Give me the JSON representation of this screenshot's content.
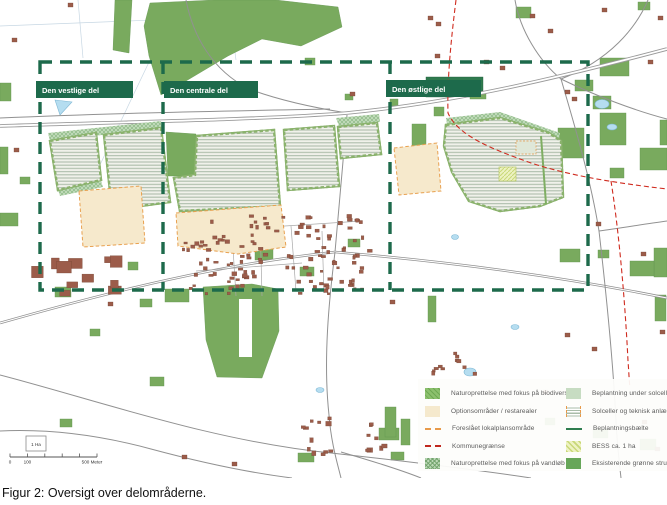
{
  "figure": {
    "caption": "Figur 2: Oversigt over delområderne."
  },
  "map": {
    "area_labels": [
      {
        "id": "west",
        "label": "Den vestlige del"
      },
      {
        "id": "central",
        "label": "Den centrale del"
      },
      {
        "id": "east",
        "label": "Den østlige del"
      }
    ],
    "scale_bar": {
      "area_unit": "1 Ha",
      "zero": "0",
      "hundred": "100",
      "end": "500 Meter"
    },
    "legend": {
      "left": [
        {
          "label": "Naturoprettelse med fokus på biodiversitet",
          "swatch": "green-diagonal-hatch",
          "color": "#8cc06d"
        },
        {
          "label": "Optionsområder / restarealer",
          "swatch": "solid",
          "color": "#f5e9cd"
        },
        {
          "label": "Foreslået lokalplansområde",
          "swatch": "dashed-line",
          "color": "#e89a4a"
        },
        {
          "label": "Kommunegrænse",
          "swatch": "dashed-line",
          "color": "#c0281e"
        },
        {
          "label": "Naturoprettelse med fokus på vandløb",
          "swatch": "green-crosshatch",
          "color": "#bcd9b7"
        }
      ],
      "right": [
        {
          "label": "Beplantning under solceller",
          "swatch": "solid",
          "color": "#c7dcc2"
        },
        {
          "label": "Solceller og teknisk anlæg",
          "swatch": "horizontal-stripes",
          "color": "#a9bca9"
        },
        {
          "label": "Beplantningsbælte",
          "swatch": "solid-line",
          "color": "#2e7d4f"
        },
        {
          "label": "BESS ca. 1 ha",
          "swatch": "yellow-diagonal-hatch",
          "color": "#eef2c2"
        },
        {
          "label": "Eksisterende grønne strukturer",
          "swatch": "solid",
          "color": "#67a659"
        }
      ]
    },
    "palette": {
      "boundary_green": "#1d6a4b",
      "kommunegraense_red": "#cf2b1f",
      "lokalplan_orange": "#e89a4a",
      "building_brown": "#9c5c4a",
      "forest_green": "#79aa5e",
      "pond_blue": "#b5ddf0"
    }
  }
}
